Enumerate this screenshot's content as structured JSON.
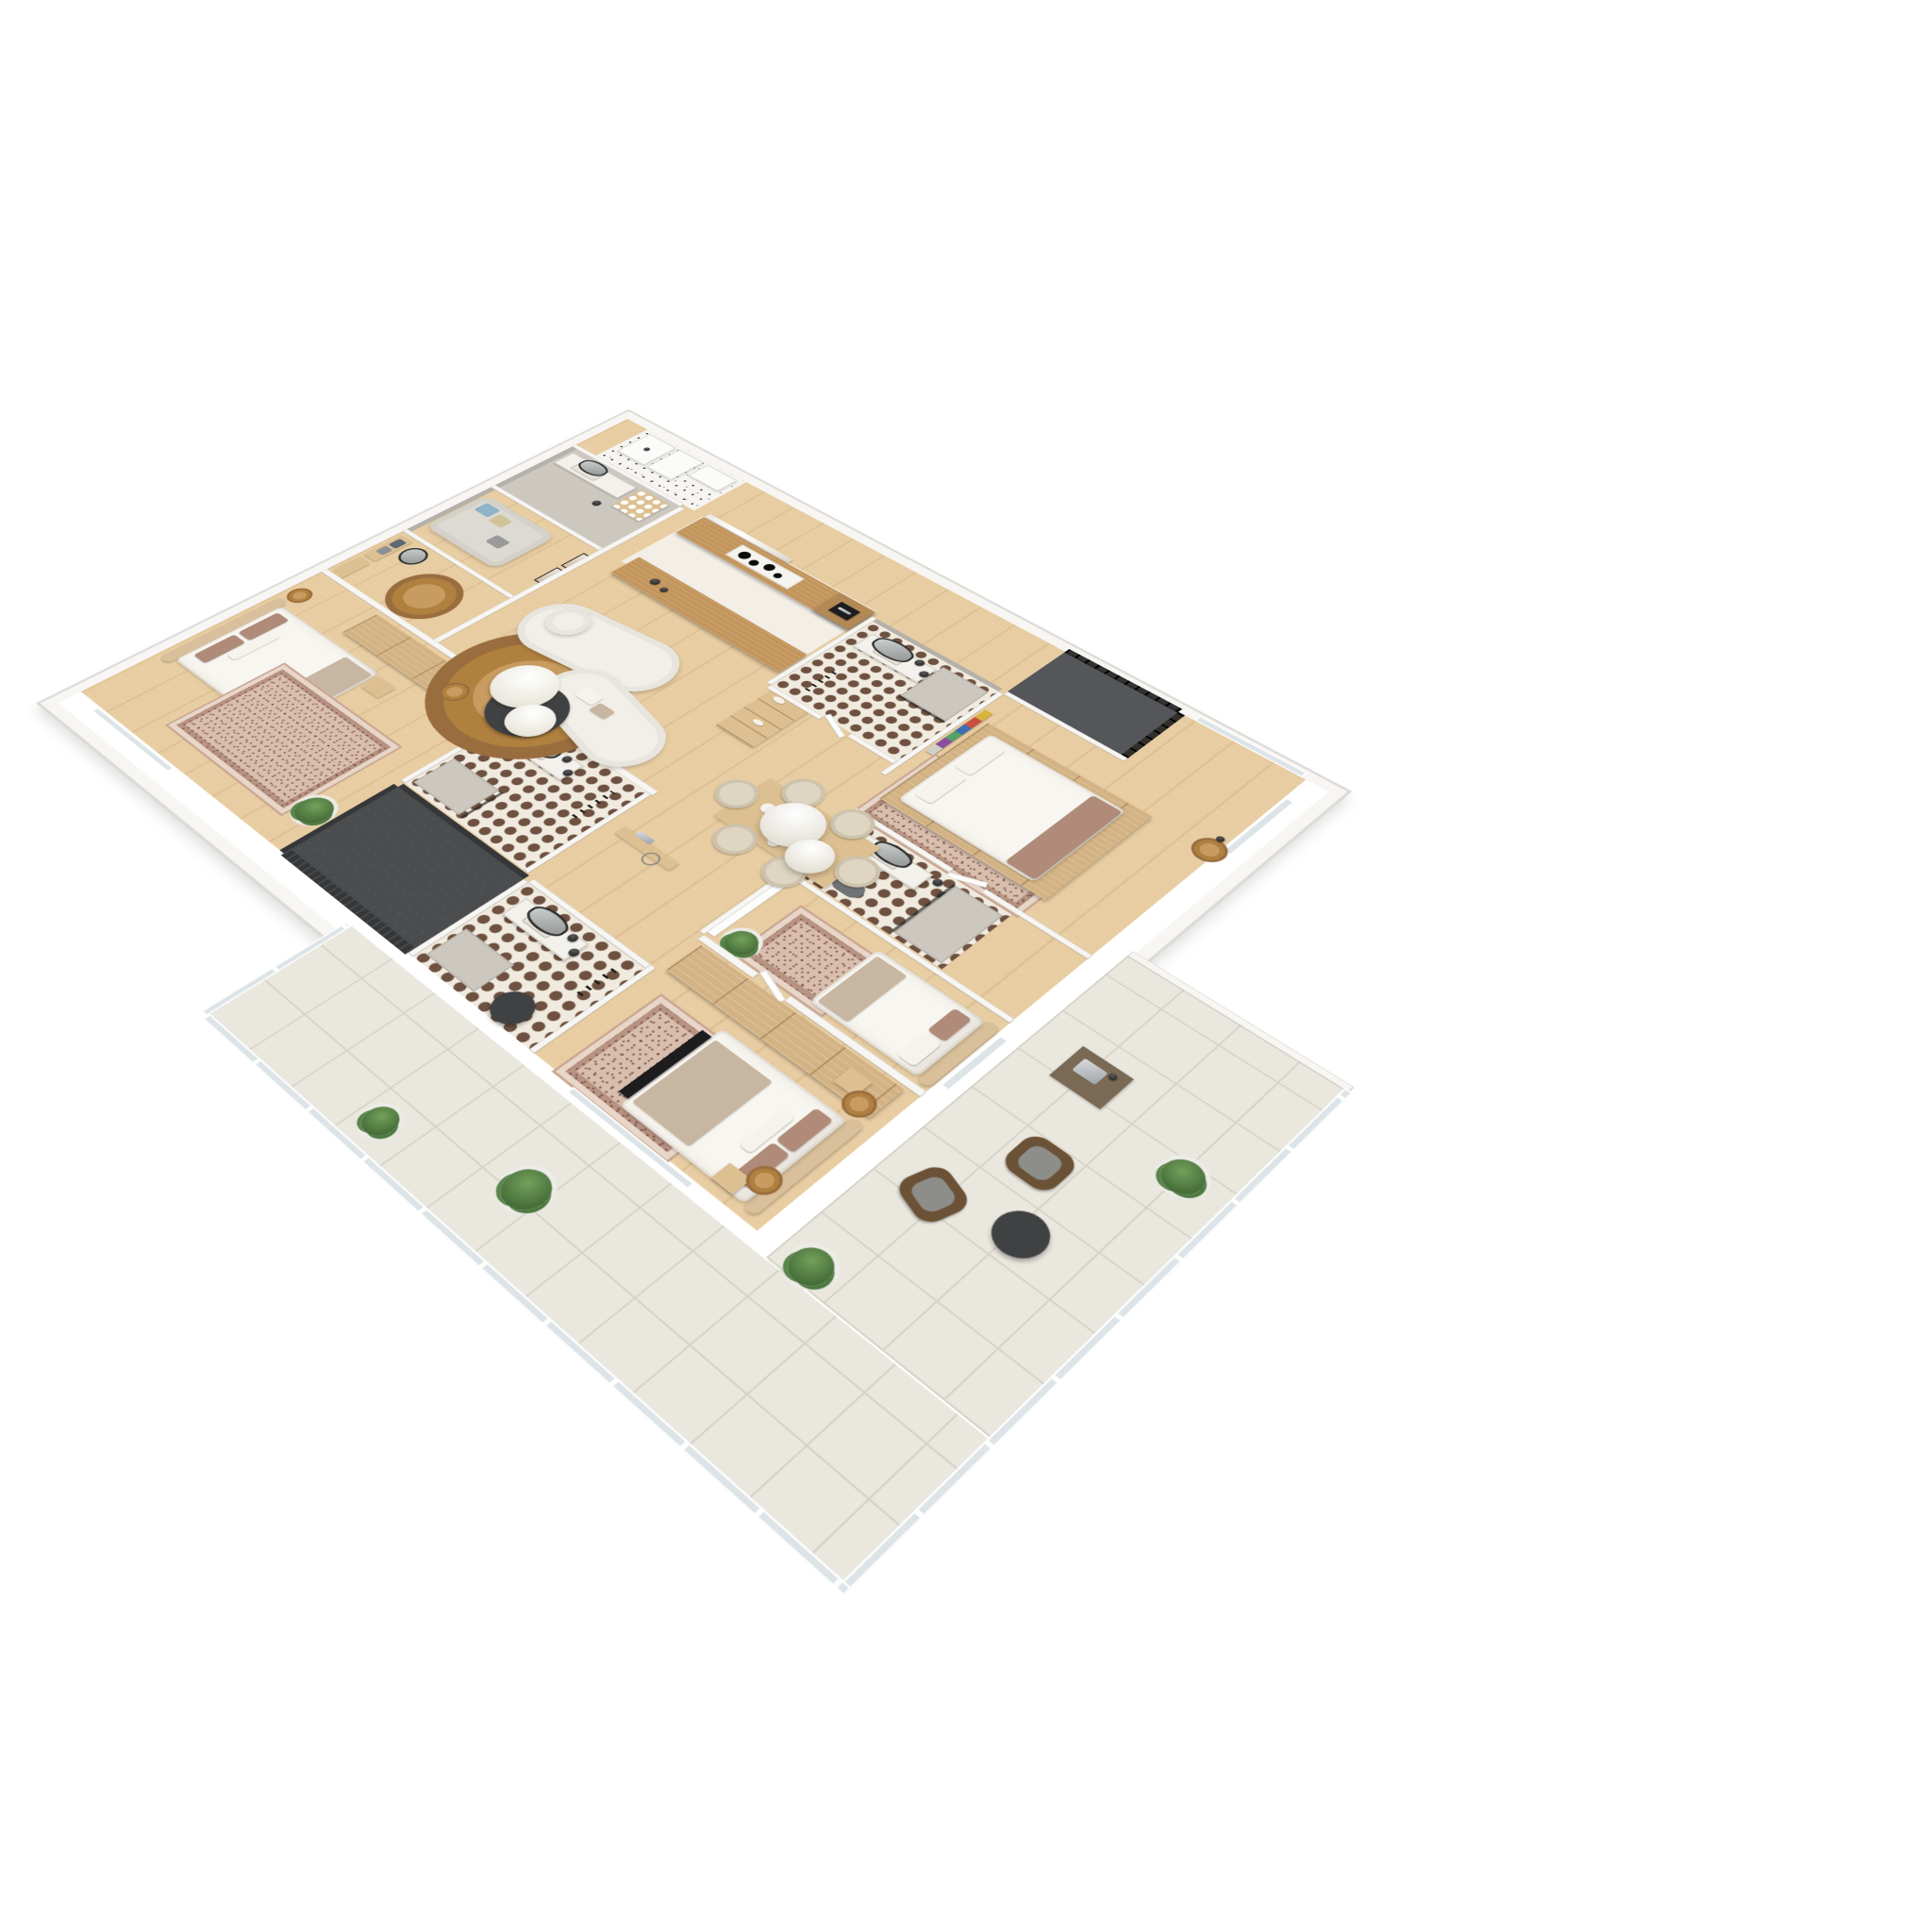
{
  "meta": {
    "kind": "3d-floor-plan-render",
    "view": "top-down axonometric, plan rotated ~44 degrees, white background",
    "visible_text": "none"
  },
  "palette": {
    "wood": "#e8cda2",
    "aisle": "#f3efe7",
    "counter_wood": "#c3955c",
    "wardrobe_wood": "#d3b283",
    "shelf_wood": "#ddc091",
    "wall": "#f7f6f3",
    "wall_edge": "#dddbd6",
    "gray_wall": "#b5b1a9",
    "gray_floor": "#ccc8c0",
    "tile_bg": "#f0eadf",
    "tile_dot": "#6e5140",
    "terrazzo_bg": "#f7f5f1",
    "dark_floor": "#4a4c4e",
    "dark_wall": "#353739",
    "terrace_tile": "#eae7df",
    "terrace_line": "#d7d3c8",
    "sofa": "#f1efe8",
    "bed_linen": "#f8f6f0",
    "headboard": "#d9c09b",
    "pillow_mauve": "#b08b79",
    "blanket_taupe": "#c7b6a1",
    "rug_base": "#d9bead",
    "jute": "#c89b60",
    "jute_dark": "#b0803f",
    "charcoal": "#3f4143",
    "glass": "#dde4e8",
    "plant": "#456d39",
    "pot": "#edece8",
    "wicker": "#6b5236"
  },
  "summary_counts": {
    "bedrooms": 4,
    "bathrooms": 5,
    "utility_rooms": 2,
    "outdoor_areas": 2
  },
  "rooms": [
    {
      "id": "laundry-utility",
      "floor": "terrazzo",
      "furniture": [
        "washing-machine",
        "dryer",
        "white-cabinet"
      ]
    },
    {
      "id": "entry-bathroom",
      "floor": "gray-concrete",
      "furniture": [
        "vanity-sink",
        "dark-oval-mirror",
        "towel-cubby-shelf",
        "black-pendant-light"
      ]
    },
    {
      "id": "sitting-nook",
      "floor": "wood",
      "furniture": [
        "gray-daybed-sofa",
        "blue-pillow",
        "sand-pillow",
        "gray-pillow",
        "framed-art-x2"
      ]
    },
    {
      "id": "entryway",
      "floor": "wood",
      "furniture": [
        "coat-rack-with-clothes",
        "drawer-console",
        "organic-mirror",
        "round-jute-rug"
      ]
    },
    {
      "id": "left-bedroom",
      "floor": "wood",
      "furniture": [
        "double-bed-curved-headboard",
        "mauve-pillows",
        "nightstand",
        "rattan-side-table",
        "cane-wardrobe-row",
        "oriental-rug",
        "fiddle-leaf-plant",
        "wall-tv"
      ]
    },
    {
      "id": "left-ensuite-bathroom",
      "floor": "circle-pattern-tiles",
      "furniture": [
        "stone-vanity",
        "oval-mirror",
        "black-pendants-x2",
        "concrete-shower",
        "black-towel-ladder"
      ]
    },
    {
      "id": "dark-storage-room",
      "floor": "charcoal",
      "furniture": []
    },
    {
      "id": "guest-bathroom",
      "floor": "circle-pattern-tiles",
      "furniture": [
        "vanity",
        "oval-mirror",
        "black-pendants-x2",
        "gray-shower",
        "dark-round-rug",
        "towel-ladder"
      ]
    },
    {
      "id": "bottom-bedroom",
      "floor": "wood",
      "furniture": [
        "double-bed-beige-headboard",
        "taupe-throw",
        "dark-bench",
        "rattan-pendant-lights-x2",
        "nightstands-x2",
        "cane-wardrobe-row",
        "oriental-rug",
        "terrace-windows"
      ]
    },
    {
      "id": "kitchen",
      "floor": "light-stone-aisle",
      "furniture": [
        "oak-counter-with-hob",
        "four-burner-cooktop",
        "built-in-oven-tower",
        "oak-island-counter",
        "marble-splashback",
        "open-shelf-unit-with-tableware"
      ]
    },
    {
      "id": "living-room",
      "floor": "wood",
      "furniture": [
        "curved-modular-cream-sofa",
        "marble-coffee-table-large",
        "marble-coffee-table-small",
        "charcoal-coffee-table",
        "tan-side-table",
        "round-jute-rug",
        "hall-console"
      ]
    },
    {
      "id": "dining-area",
      "floor": "wood",
      "furniture": [
        "oak-dining-table",
        "beige-barrel-chairs-x6",
        "table-settings",
        "white-dome-pendants-x2"
      ]
    },
    {
      "id": "top-bathroom",
      "floor": "circle-pattern-tiles",
      "furniture": [
        "vanity",
        "tall-oval-mirror",
        "black-pendants-x2",
        "glass-walk-in-shower",
        "black-towel-ladder"
      ]
    },
    {
      "id": "loggia-balcony",
      "floor": "dark-stone",
      "furniture": [
        "black-metal-railing"
      ]
    },
    {
      "id": "top-right-bedroom",
      "floor": "wood",
      "furniture": [
        "wood-platform-bed",
        "white-linen",
        "brown-foot-throw",
        "colorful-wall-artwork",
        "oriental-rug",
        "rattan-side-table",
        "floor-lamp",
        "corner-windows"
      ]
    },
    {
      "id": "middle-bathroom",
      "floor": "circle-pattern-tiles",
      "furniture": [
        "vanity",
        "oval-mirror",
        "black-pendants-x2",
        "glass-shower",
        "gray-toilet",
        "towel-rail"
      ]
    },
    {
      "id": "right-bedroom",
      "floor": "wood",
      "furniture": [
        "double-bed-beige-headboard",
        "white-closet-doors",
        "oriental-rug",
        "potted-plant",
        "terrace-windows"
      ]
    },
    {
      "id": "terrace",
      "floor": "cream-stone-tiles",
      "furniture": [
        "glass-balustrade",
        "wicker-lounge-chairs-x2",
        "round-outdoor-table",
        "outdoor-sink-unit",
        "potted-plants-x4"
      ]
    }
  ]
}
